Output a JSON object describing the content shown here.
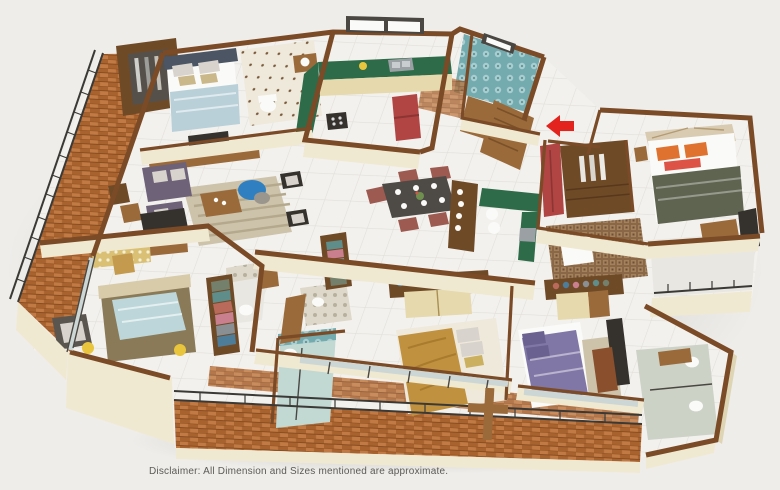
{
  "page": {
    "background": "#efedea",
    "disclaimer": "Disclaimer: All Dimension and Sizes mentioned are approximate."
  },
  "floorplan": {
    "render_style": "isometric 3D apartment floor plan",
    "entry": {
      "marker": "red arrow",
      "direction": "left",
      "location": "main entrance door on right side"
    },
    "palette": {
      "background": "#efedea",
      "text": "#5c5b57",
      "floor_marble": "#f3f1ee",
      "floor_line": "#e2dfd9",
      "wall_cap": "#7a4b26",
      "wall_face": "#f0e9d1",
      "wall_face_shade": "#ded5b4",
      "balcony_brick": "#a8622e",
      "brick_light": "#c17a43",
      "railing": "#3b3936",
      "glass": "#ccd6d4",
      "window_frame": "#4a4742",
      "kitchen_counter": "#2e6b49",
      "cabinet_cream": "#e6d9ad",
      "fridge_red": "#b04543",
      "wood": "#9a6a3a",
      "wood_dark": "#6f4a27",
      "tv_dark": "#35322e",
      "sofa_purple": "#6e6278",
      "cushion_light": "#d8d3cc",
      "rug_beige": "#cdc3ab",
      "bean_bag_blue": "#2f7fc1",
      "dining_chair": "#9c5a50",
      "table_top": "#4e4a45",
      "bed1_blanket": "#b9d0d9",
      "bed1_head": "#4b5563",
      "bed2_blanket": "#bcd6da",
      "bed2_base": "#8a7a57",
      "bed3_blanket": "#c0913f",
      "bed4_blanket": "#8177a6",
      "master_blanket": "#5f6450",
      "pillow_orange": "#e0722f",
      "pillow_red": "#dd5345",
      "white": "#fafaf8",
      "teal_tile": "#74abae",
      "teal_tile_light": "#a9cdd0",
      "dots_tile": "#efe9dc",
      "dot_brown": "#7a5a3a",
      "mosaic": "#8a6747",
      "mosaic_light": "#a3815c",
      "damask_bg": "#ded8ca",
      "damask_dot": "#b7b09e",
      "bath2_floor": "#e9e7e1",
      "bath3_floor": "#c2d8d3",
      "bath4_floor": "#ccd2c6",
      "gold_desk": "#d9c074",
      "yellow": "#e8c53c",
      "arrow_red": "#e3231d",
      "clothes_0": "#5f8d8a",
      "clothes_1": "#c97f8e",
      "clothes_2": "#8a8f94",
      "clothes_3": "#b96a5a",
      "clothes_4": "#74806b",
      "clothes_5": "#4e7d9a"
    },
    "rooms": [
      {
        "id": "balcony-left",
        "label": "Sit-out balcony",
        "features": [
          "terracotta floor",
          "metal railing",
          "wooden lounge chairs",
          "snack table"
        ]
      },
      {
        "id": "bedroom-1",
        "label": "Bedroom (top-left)",
        "features": [
          "bed with blue throw",
          "dark wood wardrobe",
          "TV console"
        ]
      },
      {
        "id": "bathroom-1",
        "label": "Attached bathroom (top)",
        "features": [
          "dotted tile wall",
          "toilet",
          "vanity"
        ]
      },
      {
        "id": "kitchen",
        "label": "Kitchen",
        "features": [
          "green granite L-counter",
          "hob",
          "steel sink",
          "red refrigerator",
          "window"
        ]
      },
      {
        "id": "store",
        "label": "Store / pantry",
        "features": [
          "terracotta floor"
        ]
      },
      {
        "id": "bathroom-common",
        "label": "Common bathroom",
        "features": [
          "teal patterned tiles",
          "window"
        ]
      },
      {
        "id": "foyer",
        "label": "Entrance foyer",
        "features": [
          "wooden main door",
          "red entry arrow"
        ]
      },
      {
        "id": "living",
        "label": "Living room",
        "features": [
          "purple sofa set",
          "wooden coffee table",
          "striped rug",
          "blue bean bag",
          "accent chairs"
        ]
      },
      {
        "id": "dining",
        "label": "Dining area",
        "features": [
          "6-seater dining table",
          "crockery unit"
        ]
      },
      {
        "id": "utility",
        "label": "Utility / wash area",
        "features": [
          "green counter",
          "sink",
          "white appliances"
        ]
      },
      {
        "id": "bedroom-2",
        "label": "Bedroom (bottom-left)",
        "features": [
          "bed with light-blue blanket",
          "study desk and chair",
          "grey armchair",
          "open wardrobe with clothes",
          "attached bathroom"
        ]
      },
      {
        "id": "bedroom-3",
        "label": "Bedroom (bottom-center)",
        "features": [
          "bed with tan duvet",
          "open wardrobe",
          "attached bathroom",
          "balcony access"
        ]
      },
      {
        "id": "bedroom-4",
        "label": "Bedroom (bottom-right)",
        "features": [
          "bed with purple duvet",
          "open wardrobe",
          "TV unit",
          "attached bathroom",
          "balcony"
        ]
      },
      {
        "id": "master-bedroom",
        "label": "Master bedroom (right)",
        "features": [
          "bed with orange pillows",
          "walk-in wardrobe",
          "red cabinet",
          "TV unit",
          "mosaic-tile bathroom",
          "balcony"
        ]
      },
      {
        "id": "balcony-bottom",
        "label": "Balcony (bottom)",
        "features": [
          "brick parapet",
          "metal railing",
          "wooden planter divider"
        ]
      }
    ]
  }
}
